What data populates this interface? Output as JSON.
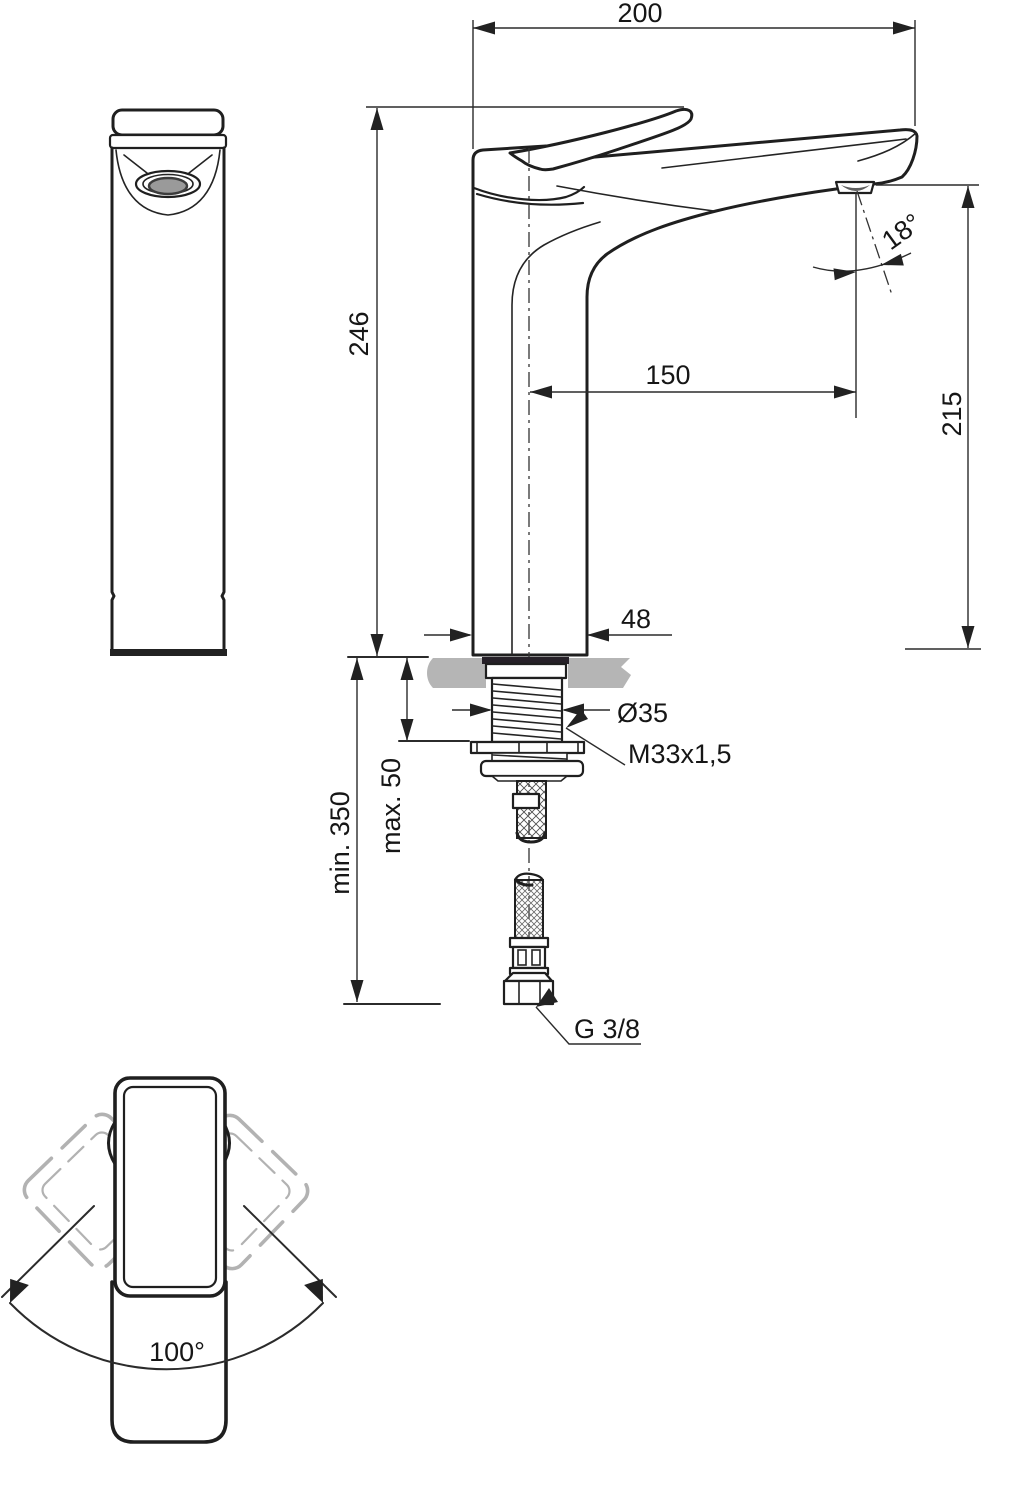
{
  "drawing": {
    "type": "technical-dimension-drawing",
    "views": {
      "front": "front view",
      "side": "side view with installation parts",
      "top": "top view handle swivel"
    },
    "dimensions": {
      "spout_width": "200",
      "total_height": "246",
      "spout_reach": "150",
      "outlet_height": "215",
      "outlet_angle": "18°",
      "body_depth": "48",
      "hole_diameter": "Ø35",
      "shank_thread": "M33x1,5",
      "deck_thickness": "max. 50",
      "clearance_below": "min. 350",
      "supply_connection": "G 3/8",
      "handle_swivel": "100°"
    },
    "colors": {
      "line": "#1f1f1f",
      "dimension_line": "#2b2b2b",
      "counter_gray": "#b5b5b5",
      "ghost_gray": "#b2b2b2",
      "aerator_gray": "#9a9a9a",
      "background": "#ffffff"
    }
  }
}
